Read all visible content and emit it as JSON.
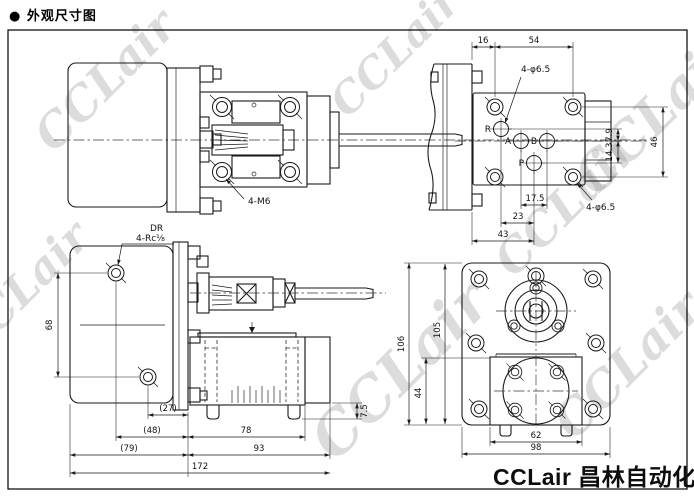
{
  "title": "● 外观尺寸图",
  "watermark_text": "CCLair",
  "brand_text": "CCLair 昌林自动化",
  "colors": {
    "ink": "#1a1a1a",
    "background": "#ffffff",
    "watermark": "#8f8f8f"
  },
  "view_top_left": {
    "bolt_label": "4-M6"
  },
  "view_top_right": {
    "dim_16": "16",
    "dim_54": "54",
    "hole_label_top": "4-φ6.5",
    "hole_label_bottom": "4-φ6.5",
    "port_r": "R",
    "port_a": "A",
    "port_b": "B",
    "port_p": "P",
    "dim_7_9": "7.9",
    "dim_14_3": "14.3",
    "dim_46": "46",
    "dim_17_5": "17.5",
    "dim_23": "23",
    "dim_43": "43"
  },
  "view_bottom_left": {
    "drain_port": "DR",
    "drain_thread": "4-Rc⅛",
    "dim_68": "68",
    "dim_7_5": "7.5",
    "dim_27": "(27)",
    "dim_48": "(48)",
    "dim_78": "78",
    "dim_79": "(79)",
    "dim_93": "93",
    "dim_172": "172"
  },
  "view_bottom_right": {
    "dim_106": "106",
    "dim_105": "105",
    "dim_44": "44",
    "dim_62": "62",
    "dim_98": "98"
  }
}
